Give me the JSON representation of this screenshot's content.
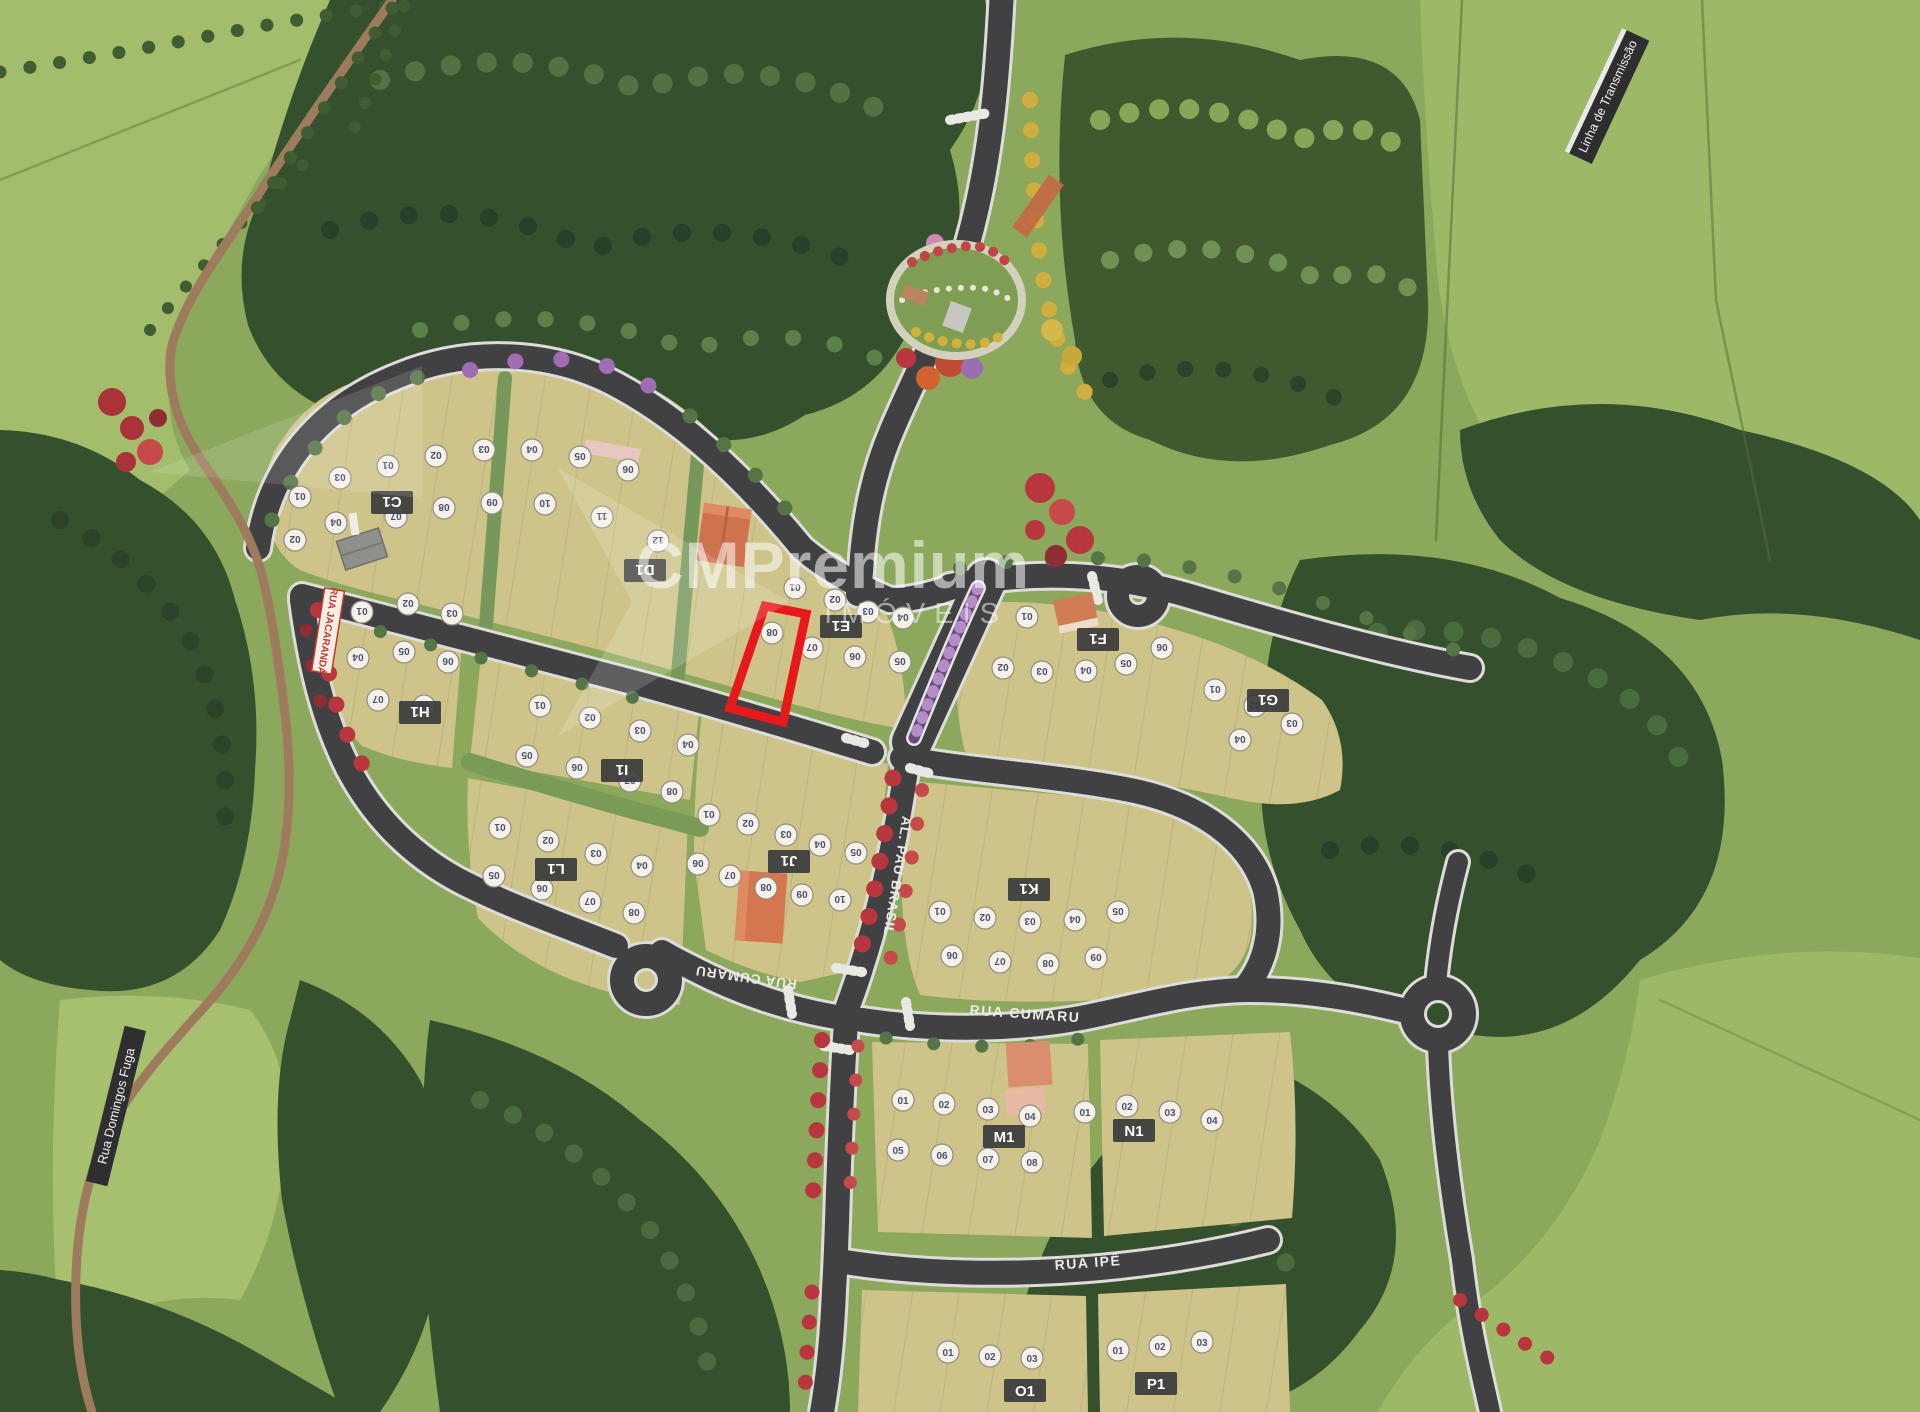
{
  "watermark": {
    "brand": "CMPremium",
    "subtitle": "IMÓVEIS"
  },
  "highlight": {
    "stroke": "#e8191c"
  },
  "palette": {
    "field": "#8ca85c",
    "pasture": "#a3bd6c",
    "forest": "#35502c",
    "block": "#cec489",
    "road": "#414144",
    "dirt_road": "#9d7b5c",
    "red_trees": "#b83a3e",
    "purple": "#9a6fb0",
    "yellow_trees": "#cfae3e",
    "label_plate": "#3a3a3c",
    "lot_circle": "#f4f1e8"
  },
  "signs": {
    "transmission_line": {
      "text": "Linha de Transmissão"
    },
    "domingos_fuga": {
      "text": "Rua Domingos Fuga"
    },
    "jacaranda": {
      "text": "RUA JACARANDÁ"
    },
    "pau_brasil": {
      "text": "AL. PAU BRASIL"
    },
    "cumaru_west": {
      "text": "RUA CUMARU"
    },
    "cumaru_east": {
      "text": "RUA CUMARU"
    },
    "ipe": {
      "text": "RUA IPÊ"
    }
  },
  "blocks": [
    {
      "label": "C1",
      "x": 392,
      "y": 502,
      "flip": 1
    },
    {
      "label": "D1",
      "x": 645,
      "y": 570,
      "flip": 1
    },
    {
      "label": "E1",
      "x": 841,
      "y": 626,
      "flip": 1
    },
    {
      "label": "F1",
      "x": 1098,
      "y": 639,
      "flip": 1
    },
    {
      "label": "G1",
      "x": 1268,
      "y": 700,
      "flip": 1
    },
    {
      "label": "H1",
      "x": 420,
      "y": 712,
      "flip": 1
    },
    {
      "label": "I1",
      "x": 622,
      "y": 770,
      "flip": 1
    },
    {
      "label": "J1",
      "x": 789,
      "y": 861,
      "flip": 1
    },
    {
      "label": "K1",
      "x": 1029,
      "y": 889,
      "flip": 1
    },
    {
      "label": "L1",
      "x": 556,
      "y": 869,
      "flip": 1
    },
    {
      "label": "M1",
      "x": 1004,
      "y": 1137,
      "flip": 0
    },
    {
      "label": "N1",
      "x": 1134,
      "y": 1131,
      "flip": 0
    },
    {
      "label": "O1",
      "x": 1025,
      "y": 1391,
      "flip": 0
    },
    {
      "label": "P1",
      "x": 1156,
      "y": 1384,
      "flip": 0
    }
  ],
  "lot_markers": [
    [
      300,
      497,
      "01",
      1
    ],
    [
      295,
      540,
      "02",
      1
    ],
    [
      340,
      478,
      "03",
      1
    ],
    [
      336,
      523,
      "04",
      1
    ],
    [
      388,
      466,
      "01",
      1
    ],
    [
      436,
      456,
      "02",
      1
    ],
    [
      484,
      450,
      "03",
      1
    ],
    [
      532,
      450,
      "04",
      1
    ],
    [
      580,
      457,
      "05",
      1
    ],
    [
      628,
      470,
      "06",
      1
    ],
    [
      396,
      517,
      "07",
      1
    ],
    [
      444,
      508,
      "08",
      1
    ],
    [
      492,
      503,
      "09",
      1
    ],
    [
      545,
      504,
      "10",
      1
    ],
    [
      602,
      517,
      "11",
      1
    ],
    [
      658,
      541,
      "12",
      1
    ],
    [
      795,
      588,
      "01",
      1
    ],
    [
      835,
      600,
      "02",
      1
    ],
    [
      868,
      612,
      "03",
      1
    ],
    [
      903,
      618,
      "04",
      1
    ],
    [
      900,
      662,
      "05",
      1
    ],
    [
      855,
      657,
      "06",
      1
    ],
    [
      812,
      648,
      "07",
      1
    ],
    [
      772,
      633,
      "08",
      1
    ],
    [
      1027,
      617,
      "01",
      1
    ],
    [
      1003,
      668,
      "02",
      1
    ],
    [
      1042,
      672,
      "03",
      1
    ],
    [
      1086,
      671,
      "04",
      1
    ],
    [
      1126,
      664,
      "05",
      1
    ],
    [
      1162,
      648,
      "06",
      1
    ],
    [
      1215,
      690,
      "01",
      1
    ],
    [
      1255,
      706,
      "02",
      1
    ],
    [
      1292,
      724,
      "03",
      1
    ],
    [
      1240,
      740,
      "04",
      1
    ],
    [
      362,
      612,
      "01",
      1
    ],
    [
      408,
      604,
      "02",
      1
    ],
    [
      452,
      614,
      "03",
      1
    ],
    [
      358,
      658,
      "04",
      1
    ],
    [
      404,
      652,
      "05",
      1
    ],
    [
      448,
      662,
      "06",
      1
    ],
    [
      378,
      700,
      "07",
      1
    ],
    [
      424,
      706,
      "08",
      1
    ],
    [
      540,
      706,
      "01",
      1
    ],
    [
      590,
      718,
      "02",
      1
    ],
    [
      640,
      731,
      "03",
      1
    ],
    [
      688,
      745,
      "04",
      1
    ],
    [
      527,
      756,
      "05",
      1
    ],
    [
      577,
      768,
      "06",
      1
    ],
    [
      630,
      781,
      "07",
      1
    ],
    [
      672,
      792,
      "08",
      1
    ],
    [
      709,
      815,
      "01",
      1
    ],
    [
      748,
      824,
      "02",
      1
    ],
    [
      786,
      835,
      "03",
      1
    ],
    [
      820,
      845,
      "04",
      1
    ],
    [
      856,
      853,
      "05",
      1
    ],
    [
      698,
      864,
      "06",
      1
    ],
    [
      730,
      876,
      "07",
      1
    ],
    [
      766,
      888,
      "08",
      1
    ],
    [
      802,
      895,
      "09",
      1
    ],
    [
      840,
      900,
      "10",
      1
    ],
    [
      940,
      912,
      "01",
      1
    ],
    [
      985,
      918,
      "02",
      1
    ],
    [
      1030,
      922,
      "03",
      1
    ],
    [
      1075,
      920,
      "04",
      1
    ],
    [
      1118,
      912,
      "05",
      1
    ],
    [
      952,
      956,
      "06",
      1
    ],
    [
      1000,
      962,
      "07",
      1
    ],
    [
      1048,
      964,
      "08",
      1
    ],
    [
      1096,
      958,
      "09",
      1
    ],
    [
      500,
      828,
      "01",
      1
    ],
    [
      548,
      841,
      "02",
      1
    ],
    [
      596,
      854,
      "03",
      1
    ],
    [
      642,
      866,
      "04",
      1
    ],
    [
      494,
      876,
      "05",
      1
    ],
    [
      542,
      889,
      "06",
      1
    ],
    [
      590,
      902,
      "07",
      1
    ],
    [
      634,
      913,
      "08",
      1
    ],
    [
      903,
      1100,
      "01",
      0
    ],
    [
      944,
      1104,
      "02",
      0
    ],
    [
      988,
      1109,
      "03",
      0
    ],
    [
      1030,
      1116,
      "04",
      0
    ],
    [
      898,
      1150,
      "05",
      0
    ],
    [
      942,
      1155,
      "06",
      0
    ],
    [
      988,
      1159,
      "07",
      0
    ],
    [
      1032,
      1162,
      "08",
      0
    ],
    [
      1085,
      1112,
      "01",
      0
    ],
    [
      1127,
      1106,
      "02",
      0
    ],
    [
      1170,
      1112,
      "03",
      0
    ],
    [
      1212,
      1120,
      "04",
      0
    ],
    [
      948,
      1352,
      "01",
      0
    ],
    [
      990,
      1356,
      "02",
      0
    ],
    [
      1032,
      1358,
      "03",
      0
    ],
    [
      1118,
      1350,
      "01",
      0
    ],
    [
      1160,
      1346,
      "02",
      0
    ],
    [
      1202,
      1342,
      "03",
      0
    ]
  ]
}
